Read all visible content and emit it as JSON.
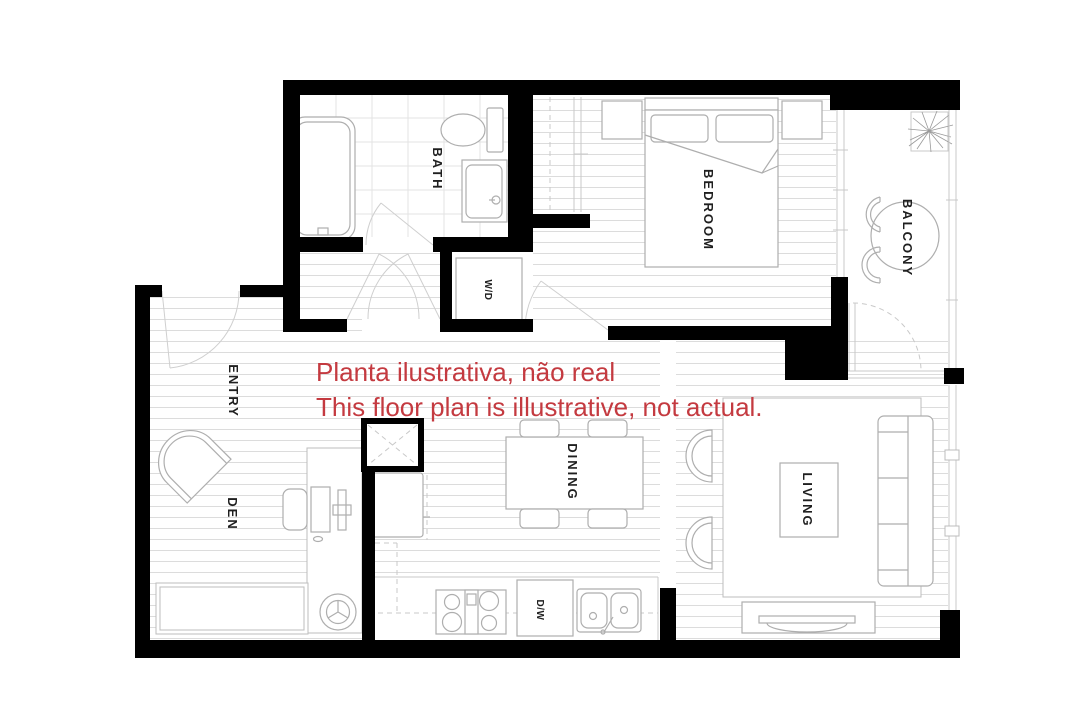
{
  "overlay": {
    "line1": "Planta ilustrativa, não real",
    "line2": "This floor plan is illustrative, not actual.",
    "color": "#c43a40"
  },
  "rooms": {
    "bath": {
      "label": "BATH"
    },
    "washer_dryer": {
      "label": "W/D"
    },
    "bedroom": {
      "label": "BEDROOM"
    },
    "balcony": {
      "label": "BALCONY"
    },
    "entry": {
      "label": "ENTRY"
    },
    "den": {
      "label": "DEN"
    },
    "dining": {
      "label": "DINING"
    },
    "living": {
      "label": "LIVING"
    },
    "dishwasher": {
      "label": "D/W"
    }
  },
  "colors": {
    "walls": "#000000",
    "floor_lines": "#dcdcdc",
    "fixtures": "#aeaeae",
    "overlay_red": "#c43a40",
    "background": "#ffffff"
  }
}
